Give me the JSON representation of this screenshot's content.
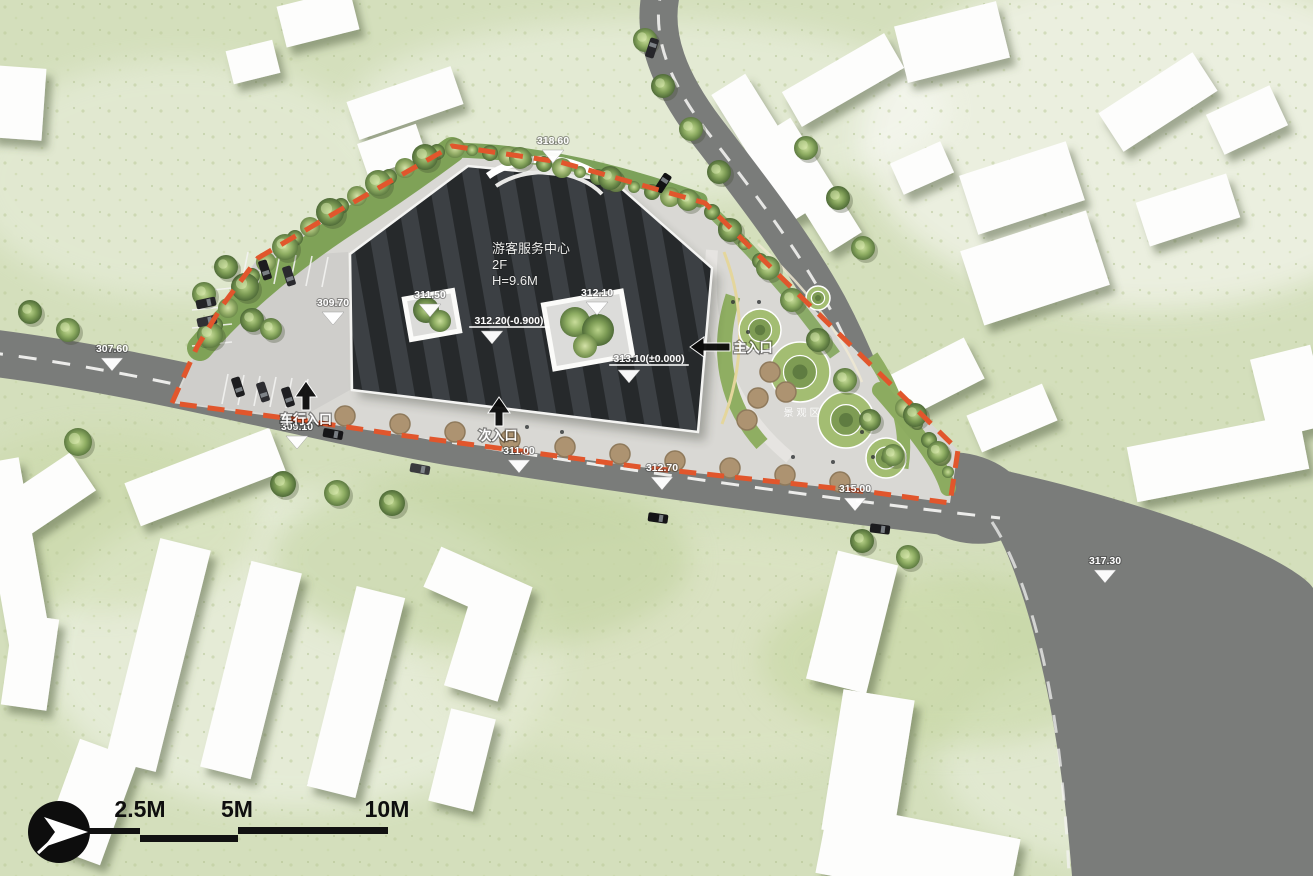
{
  "plan": {
    "building": {
      "name_label": "游客服务中心",
      "floors_label": "2F",
      "height_label": "H=9.6M"
    },
    "entrances": [
      {
        "id": "main-entrance",
        "label": "主入口",
        "direction": "left",
        "arrow_x": 690,
        "arrow_y": 347,
        "label_x": 753,
        "label_y": 352
      },
      {
        "id": "secondary-entrance",
        "label": "次入口",
        "direction": "up",
        "arrow_x": 499,
        "arrow_y": 426,
        "label_x": 498,
        "label_y": 440
      },
      {
        "id": "vehicle-entrance",
        "label": "车行入口",
        "direction": "up",
        "arrow_x": 306,
        "arrow_y": 410,
        "label_x": 306,
        "label_y": 424
      }
    ],
    "elevation_markers": [
      {
        "label": "318.60",
        "x": 553,
        "y": 150
      },
      {
        "label": "307.60",
        "x": 112,
        "y": 358
      },
      {
        "label": "309.70",
        "x": 333,
        "y": 312
      },
      {
        "label": "311.50",
        "x": 430,
        "y": 304
      },
      {
        "label": "312.10",
        "x": 597,
        "y": 302
      },
      {
        "label": "312.20(-0.900)",
        "x": 492,
        "y": 331,
        "text_x": 509,
        "text_y": 324,
        "underline": true
      },
      {
        "label": "313.10(±0.000)",
        "x": 629,
        "y": 370,
        "text_x": 649,
        "text_y": 362,
        "underline": true
      },
      {
        "label": "309.10",
        "x": 297,
        "y": 436
      },
      {
        "label": "311.00",
        "x": 519,
        "y": 460
      },
      {
        "label": "312.70",
        "x": 662,
        "y": 477
      },
      {
        "label": "315.00",
        "x": 855,
        "y": 498
      },
      {
        "label": "317.30",
        "x": 1105,
        "y": 570
      }
    ],
    "area_label": {
      "text": "景观区"
    },
    "scale_bar": {
      "labels": [
        {
          "text": "2.5M",
          "x": 140
        },
        {
          "text": "5M",
          "x": 237
        },
        {
          "text": "10M",
          "x": 387
        }
      ]
    },
    "north_arrow_name": "north-arrow",
    "colors": {
      "boundary": "#e1562c",
      "road": "#7a7c7a",
      "roof_dark": "#26292b",
      "roof_stripe": "#3c4044",
      "grass": "#d4dfbc",
      "plaza": "#d9d8d4"
    }
  }
}
